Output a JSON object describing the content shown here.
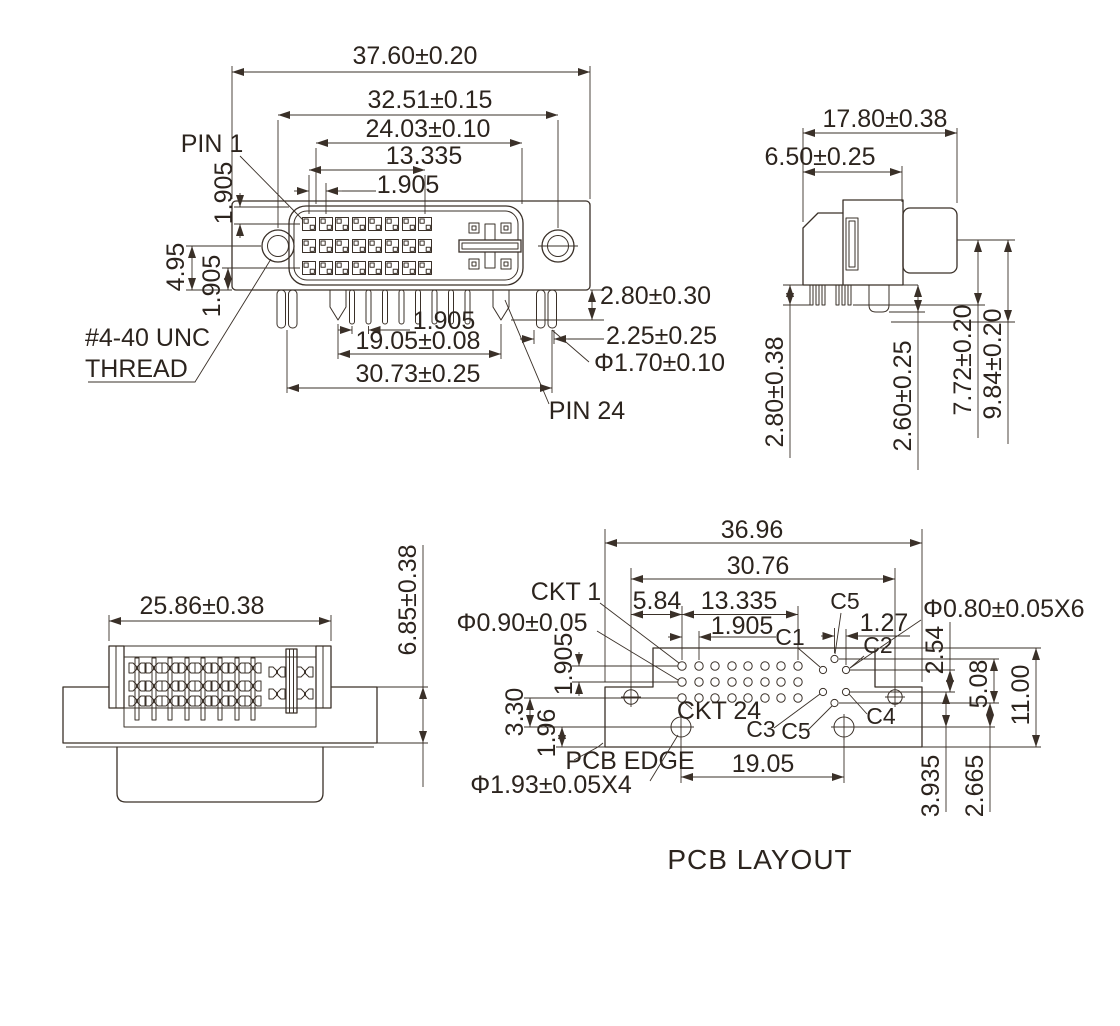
{
  "drawing": {
    "background": "#ffffff",
    "line_color": "#3a3028",
    "text_color": "#2c241e",
    "title": "PCB LAYOUT"
  },
  "front_view": {
    "pin1_label": "PIN 1",
    "pin24_label": "PIN 24",
    "thread_label_line1": "#4-40 UNC",
    "thread_label_line2": "THREAD",
    "dim_width_outer": "37.60±0.20",
    "dim_screw_span": "32.51±0.15",
    "dim_shroud_width": "24.03±0.10",
    "dim_contact_span": "13.335",
    "dim_contact_pitch": "1.905",
    "dim_row_offset": "1.905",
    "dim_height_mid": "4.95",
    "dim_row_lower": "1.905",
    "dim_pin_pitch": "1.905",
    "dim_pin_span": "19.05±0.08",
    "dim_boardlock_span": "30.73±0.25",
    "dim_pin_length": "2.80±0.30",
    "dim_lock_offset": "2.25±0.25",
    "dim_lock_hole": "Φ1.70±0.10"
  },
  "side_view": {
    "dim_depth_total": "17.80±0.38",
    "dim_body_depth": "6.50±0.25",
    "dim_pin_length": "2.80±0.38",
    "dim_lock_length": "2.60±0.25",
    "dim_height_front": "7.72±0.20",
    "dim_height_back": "9.84±0.20"
  },
  "rear_view": {
    "dim_width": "25.86±0.38",
    "dim_height": "6.85±0.38"
  },
  "pcb_layout": {
    "title": "PCB LAYOUT",
    "ckt1_label": "CKT 1",
    "ckt24_label": "CKT 24",
    "pcb_edge_label": "PCB EDGE",
    "c1": "C1",
    "c2": "C2",
    "c3": "C3",
    "c4": "C4",
    "c5_top": "C5",
    "c5_bottom": "C5",
    "dim_board_width": "36.96",
    "dim_mount_span": "30.76",
    "dim_hole_offset": "5.84",
    "dim_grid_span": "13.335",
    "dim_grid_pitch": "1.905",
    "dim_c_pitch": "1.27",
    "dim_c_hole": "Φ0.80±0.05X6",
    "dim_signal_hole": "Φ0.90±0.05",
    "dim_row_pitch": "1.905",
    "dim_row_to_mount": "3.30",
    "dim_mount_to_edge": "1.96",
    "dim_mount_span_bottom": "19.05",
    "dim_mount_hole": "Φ1.93±0.05X4",
    "dim_c_row_pitch": "2.54",
    "dim_c_col_span": "5.08",
    "dim_board_height": "11.00",
    "dim_c4_to_mount": "3.935",
    "dim_c5_to_mount": "2.665"
  }
}
